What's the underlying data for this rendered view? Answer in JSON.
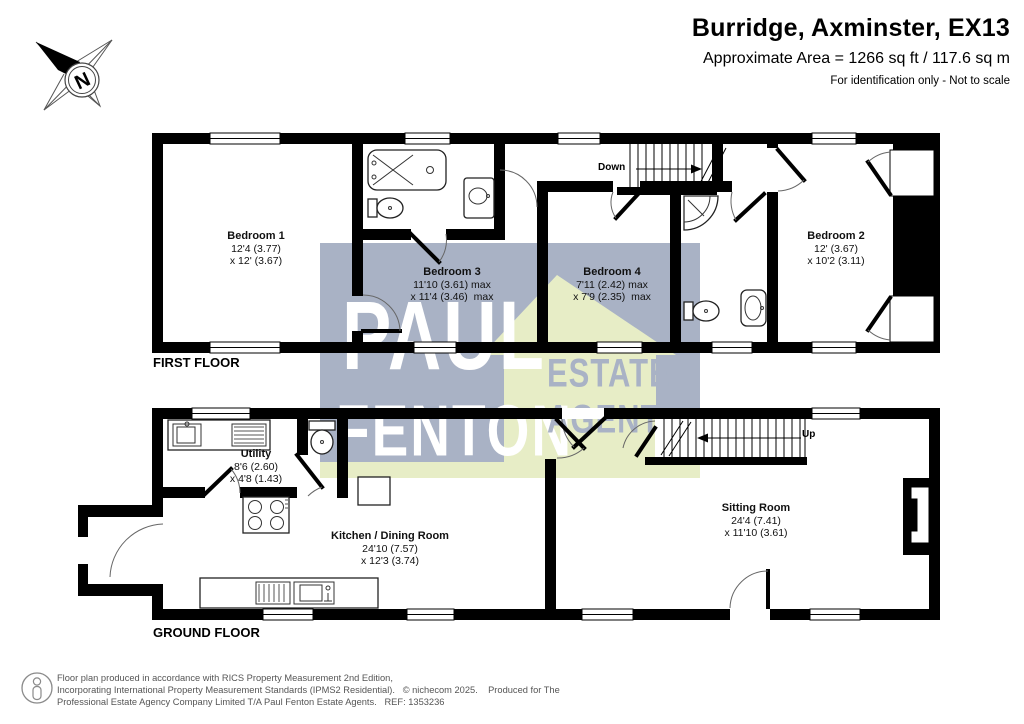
{
  "header": {
    "title": "Burridge, Axminster, EX13",
    "area": "Approximate Area = 1266 sq ft / 117.6 sq m",
    "disclaimer": "For identification only - Not to scale"
  },
  "compass": {
    "north_label": "N"
  },
  "watermark": {
    "word1": "PAUL",
    "word2": "FENTON",
    "word3": "ESTATE",
    "word4": "AGENTS",
    "grey_color": "#a9b2c5",
    "green_color": "#e7edc6"
  },
  "first_floor": {
    "title": "FIRST FLOOR",
    "stairs_label": "Down",
    "rooms": {
      "bedroom1": {
        "name": "Bedroom 1",
        "dim1": "12'4 (3.77)",
        "dim2": "x 12' (3.67)"
      },
      "bedroom3": {
        "name": "Bedroom 3",
        "dim1": "11'10 (3.61) max",
        "dim2": "x 11'4 (3.46)  max"
      },
      "bedroom4": {
        "name": "Bedroom 4",
        "dim1": "7'11 (2.42) max",
        "dim2": "x 7'9 (2.35)  max"
      },
      "bedroom2": {
        "name": "Bedroom 2",
        "dim1": "12' (3.67)",
        "dim2": "x 10'2 (3.11)"
      }
    }
  },
  "ground_floor": {
    "title": "GROUND FLOOR",
    "stairs_label": "Up",
    "rooms": {
      "utility": {
        "name": "Utility",
        "dim1": "8'6 (2.60)",
        "dim2": "x 4'8 (1.43)"
      },
      "kitchen": {
        "name": "Kitchen / Dining Room",
        "dim1": "24'10 (7.57)",
        "dim2": "x 12'3 (3.74)"
      },
      "sitting": {
        "name": "Sitting Room",
        "dim1": "24'4 (7.41)",
        "dim2": "x 11'10 (3.61)"
      }
    }
  },
  "footer": {
    "line1": "Floor plan produced in accordance with RICS Property Measurement 2nd Edition,",
    "line2": "Incorporating International Property Measurement Standards (IPMS2 Residential).   © nichecom 2025.    Produced for The",
    "line3": "Professional Estate Agency Company Limited T/A Paul Fenton Estate Agents.   REF: 1353236"
  }
}
